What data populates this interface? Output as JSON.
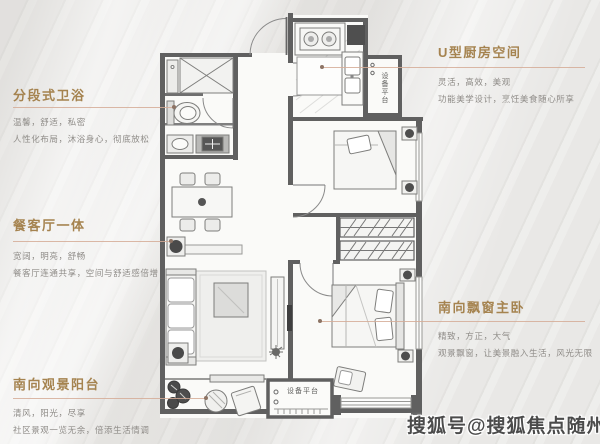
{
  "annotations": {
    "left": [
      {
        "title": "分段式卫浴",
        "line1": "温馨，舒适，私密",
        "line2": "人性化布局，沐浴身心，彻底放松"
      },
      {
        "title": "餐客厅一体",
        "line1": "宽阔，明亮，舒畅",
        "line2": "餐客厅连通共享，空间与舒适感倍增"
      },
      {
        "title": "南向观景阳台",
        "line1": "清风，阳光，尽享",
        "line2": "社区景观一览无余，倍添生活情调"
      }
    ],
    "right": [
      {
        "title": "U型厨房空间",
        "line1": "灵活，高效，美观",
        "line2": "功能美学设计，烹饪美食随心所享"
      },
      {
        "title": "南向飘窗主卧",
        "line1": "精致，方正，大气",
        "line2": "观景飘窗，让美景融入生活，风光无限"
      }
    ]
  },
  "floorplan": {
    "equipment_platform_top_label": "设备平台",
    "equipment_platform_bottom_label": "设备平台"
  },
  "watermark": {
    "text": "搜狐号@搜狐焦点随州站"
  },
  "colors": {
    "title": "#a5834f",
    "body_text": "#8f8c88",
    "leader_line": "#d5ab97",
    "wall": "#606060",
    "watermark": "#2b2b2b"
  }
}
